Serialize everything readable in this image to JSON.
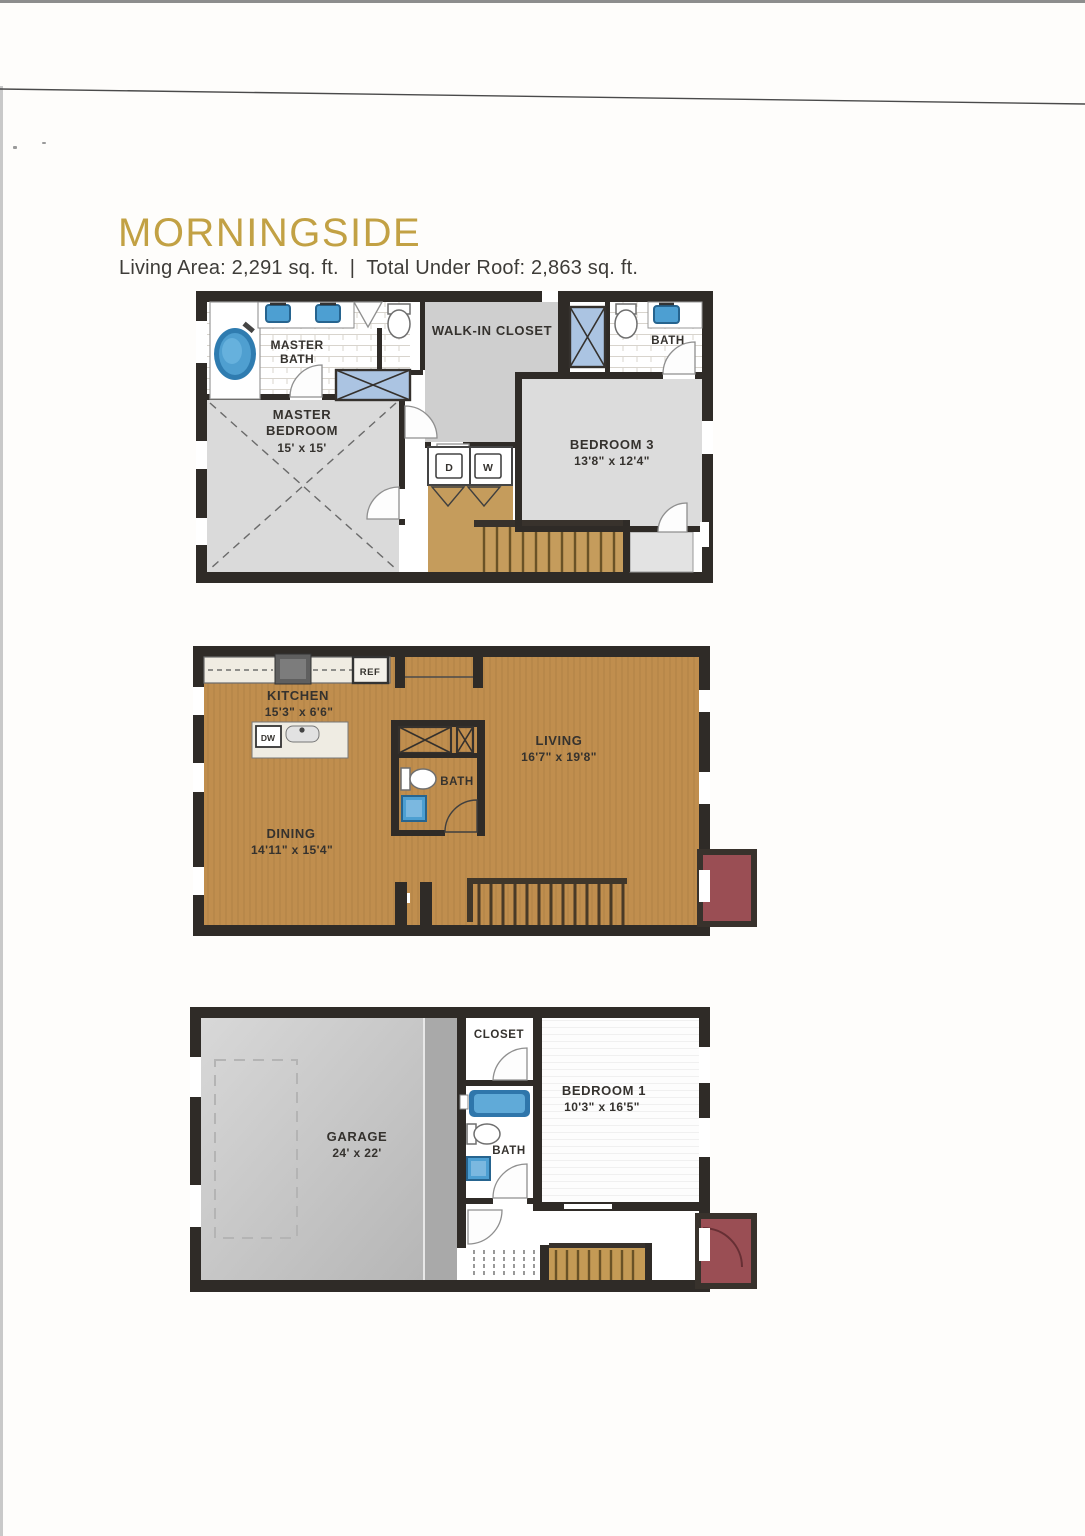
{
  "header": {
    "title": "MORNINGSIDE",
    "living_area": "Living Area: 2,291 sq. ft.",
    "separator": "|",
    "total_under_roof": "Total Under Roof: 2,863 sq. ft."
  },
  "colors": {
    "title_gold": "#c2a144",
    "label_ink": "#35322e",
    "wall_dark": "#2f2b27",
    "wood_tan": "#c08e4e",
    "stair_tan": "#c59c5c",
    "fixture_blue": "#4d9fd2",
    "shower_blue": "#abc4e2",
    "porch_red": "#9a4e54",
    "garage_gray": "#c7c7c7",
    "room_gray": "#dadada"
  },
  "upper_floor": {
    "master_bath_line1": "MASTER",
    "master_bath_line2": "BATH",
    "walk_in_closet": "WALK-IN CLOSET",
    "bath": "BATH",
    "dryer": "D",
    "washer": "W",
    "master_bedroom_line1": "MASTER",
    "master_bedroom_line2": "BEDROOM",
    "master_bedroom_dims": "15' x 15'",
    "bedroom3_name": "BEDROOM 3",
    "bedroom3_dims": "13'8\" x 12'4\""
  },
  "main_floor": {
    "kitchen_name": "KITCHEN",
    "kitchen_dims": "15'3\" x 6'6\"",
    "ref": "REF",
    "dw": "DW",
    "living_name": "LIVING",
    "living_dims": "16'7\" x 19'8\"",
    "bath": "BATH",
    "dining_name": "DINING",
    "dining_dims": "14'11\" x 15'4\""
  },
  "ground_floor": {
    "garage_name": "GARAGE",
    "garage_dims": "24' x 22'",
    "closet": "CLOSET",
    "bedroom1_name": "BEDROOM 1",
    "bedroom1_dims": "10'3\" x 16'5\"",
    "bath": "BATH"
  }
}
